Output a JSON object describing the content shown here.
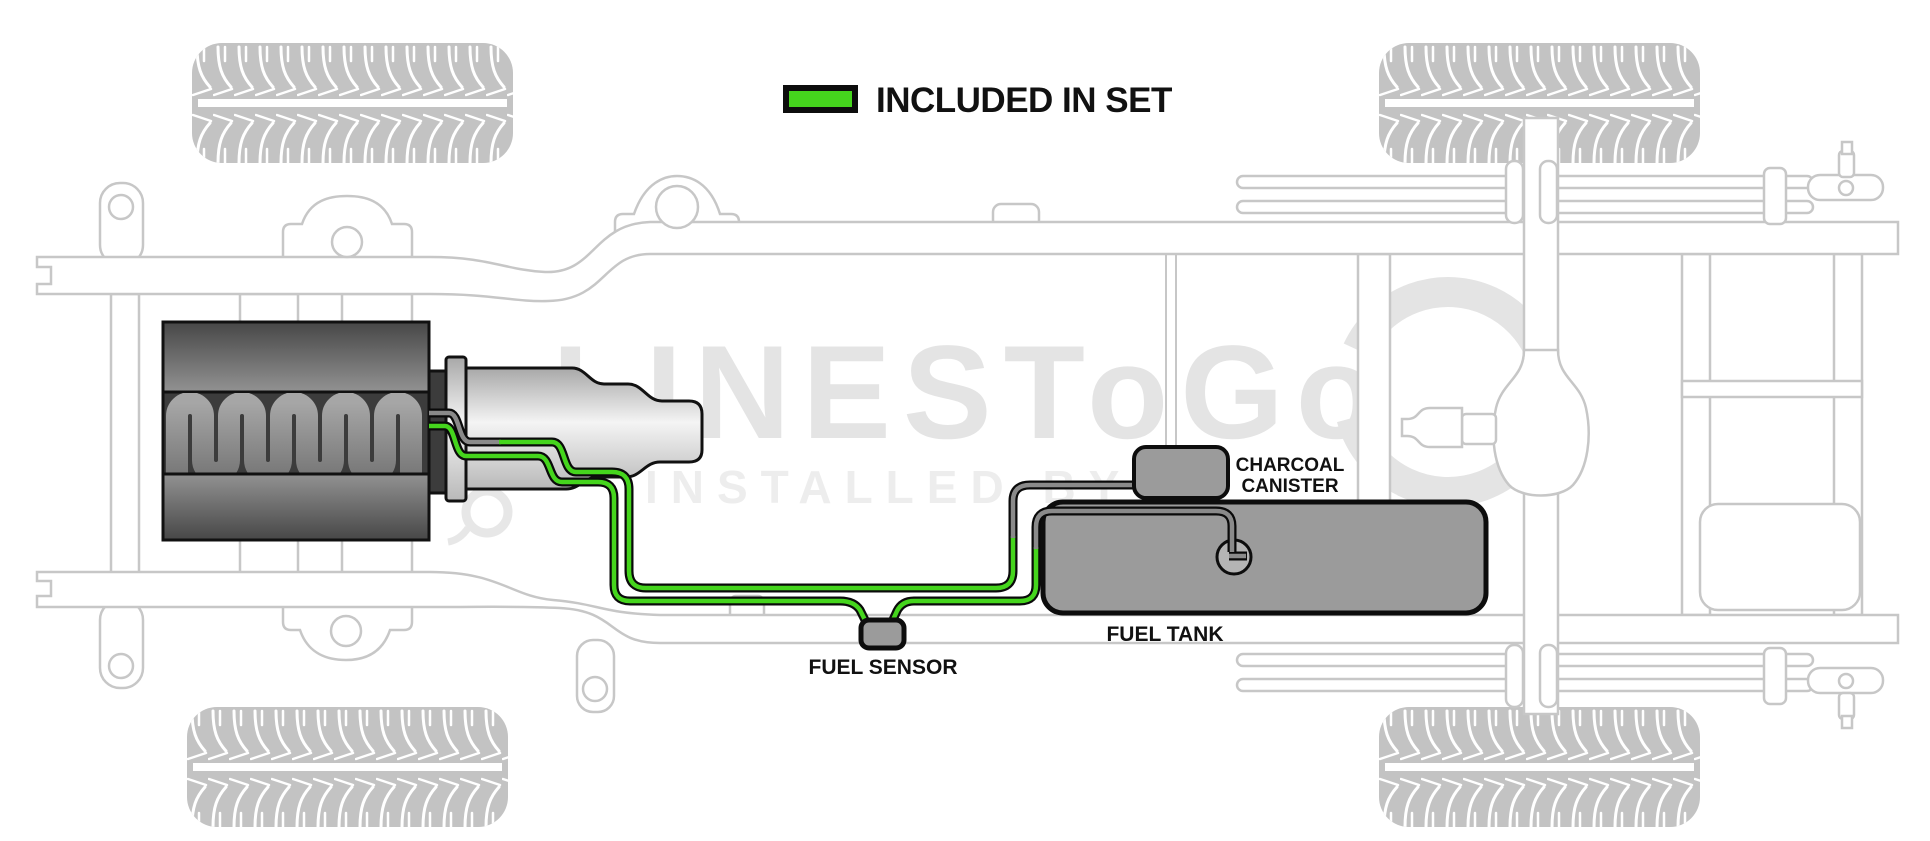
{
  "legend": {
    "label": "INCLUDED IN SET",
    "swatch_color": "#45d51d"
  },
  "labels": {
    "charcoal_line1": "CHARCOAL",
    "charcoal_line2": "CANISTER",
    "fuel_tank": "FUEL TANK",
    "fuel_sensor": "FUEL SENSOR"
  },
  "watermark": {
    "brand": "LINESToGo",
    "tagline": "INSTALLED BY"
  },
  "colors": {
    "included_green": "#45d51d",
    "line_gray": "#8a8a8a",
    "component_fill": "#9b9b9b",
    "pump_fill": "#b4b4b4",
    "chassis_line": "#c7c7c7",
    "watermark_gray": "#e4e4e4",
    "engine_dark": "#3c3c3c",
    "label_text": "#111111"
  }
}
